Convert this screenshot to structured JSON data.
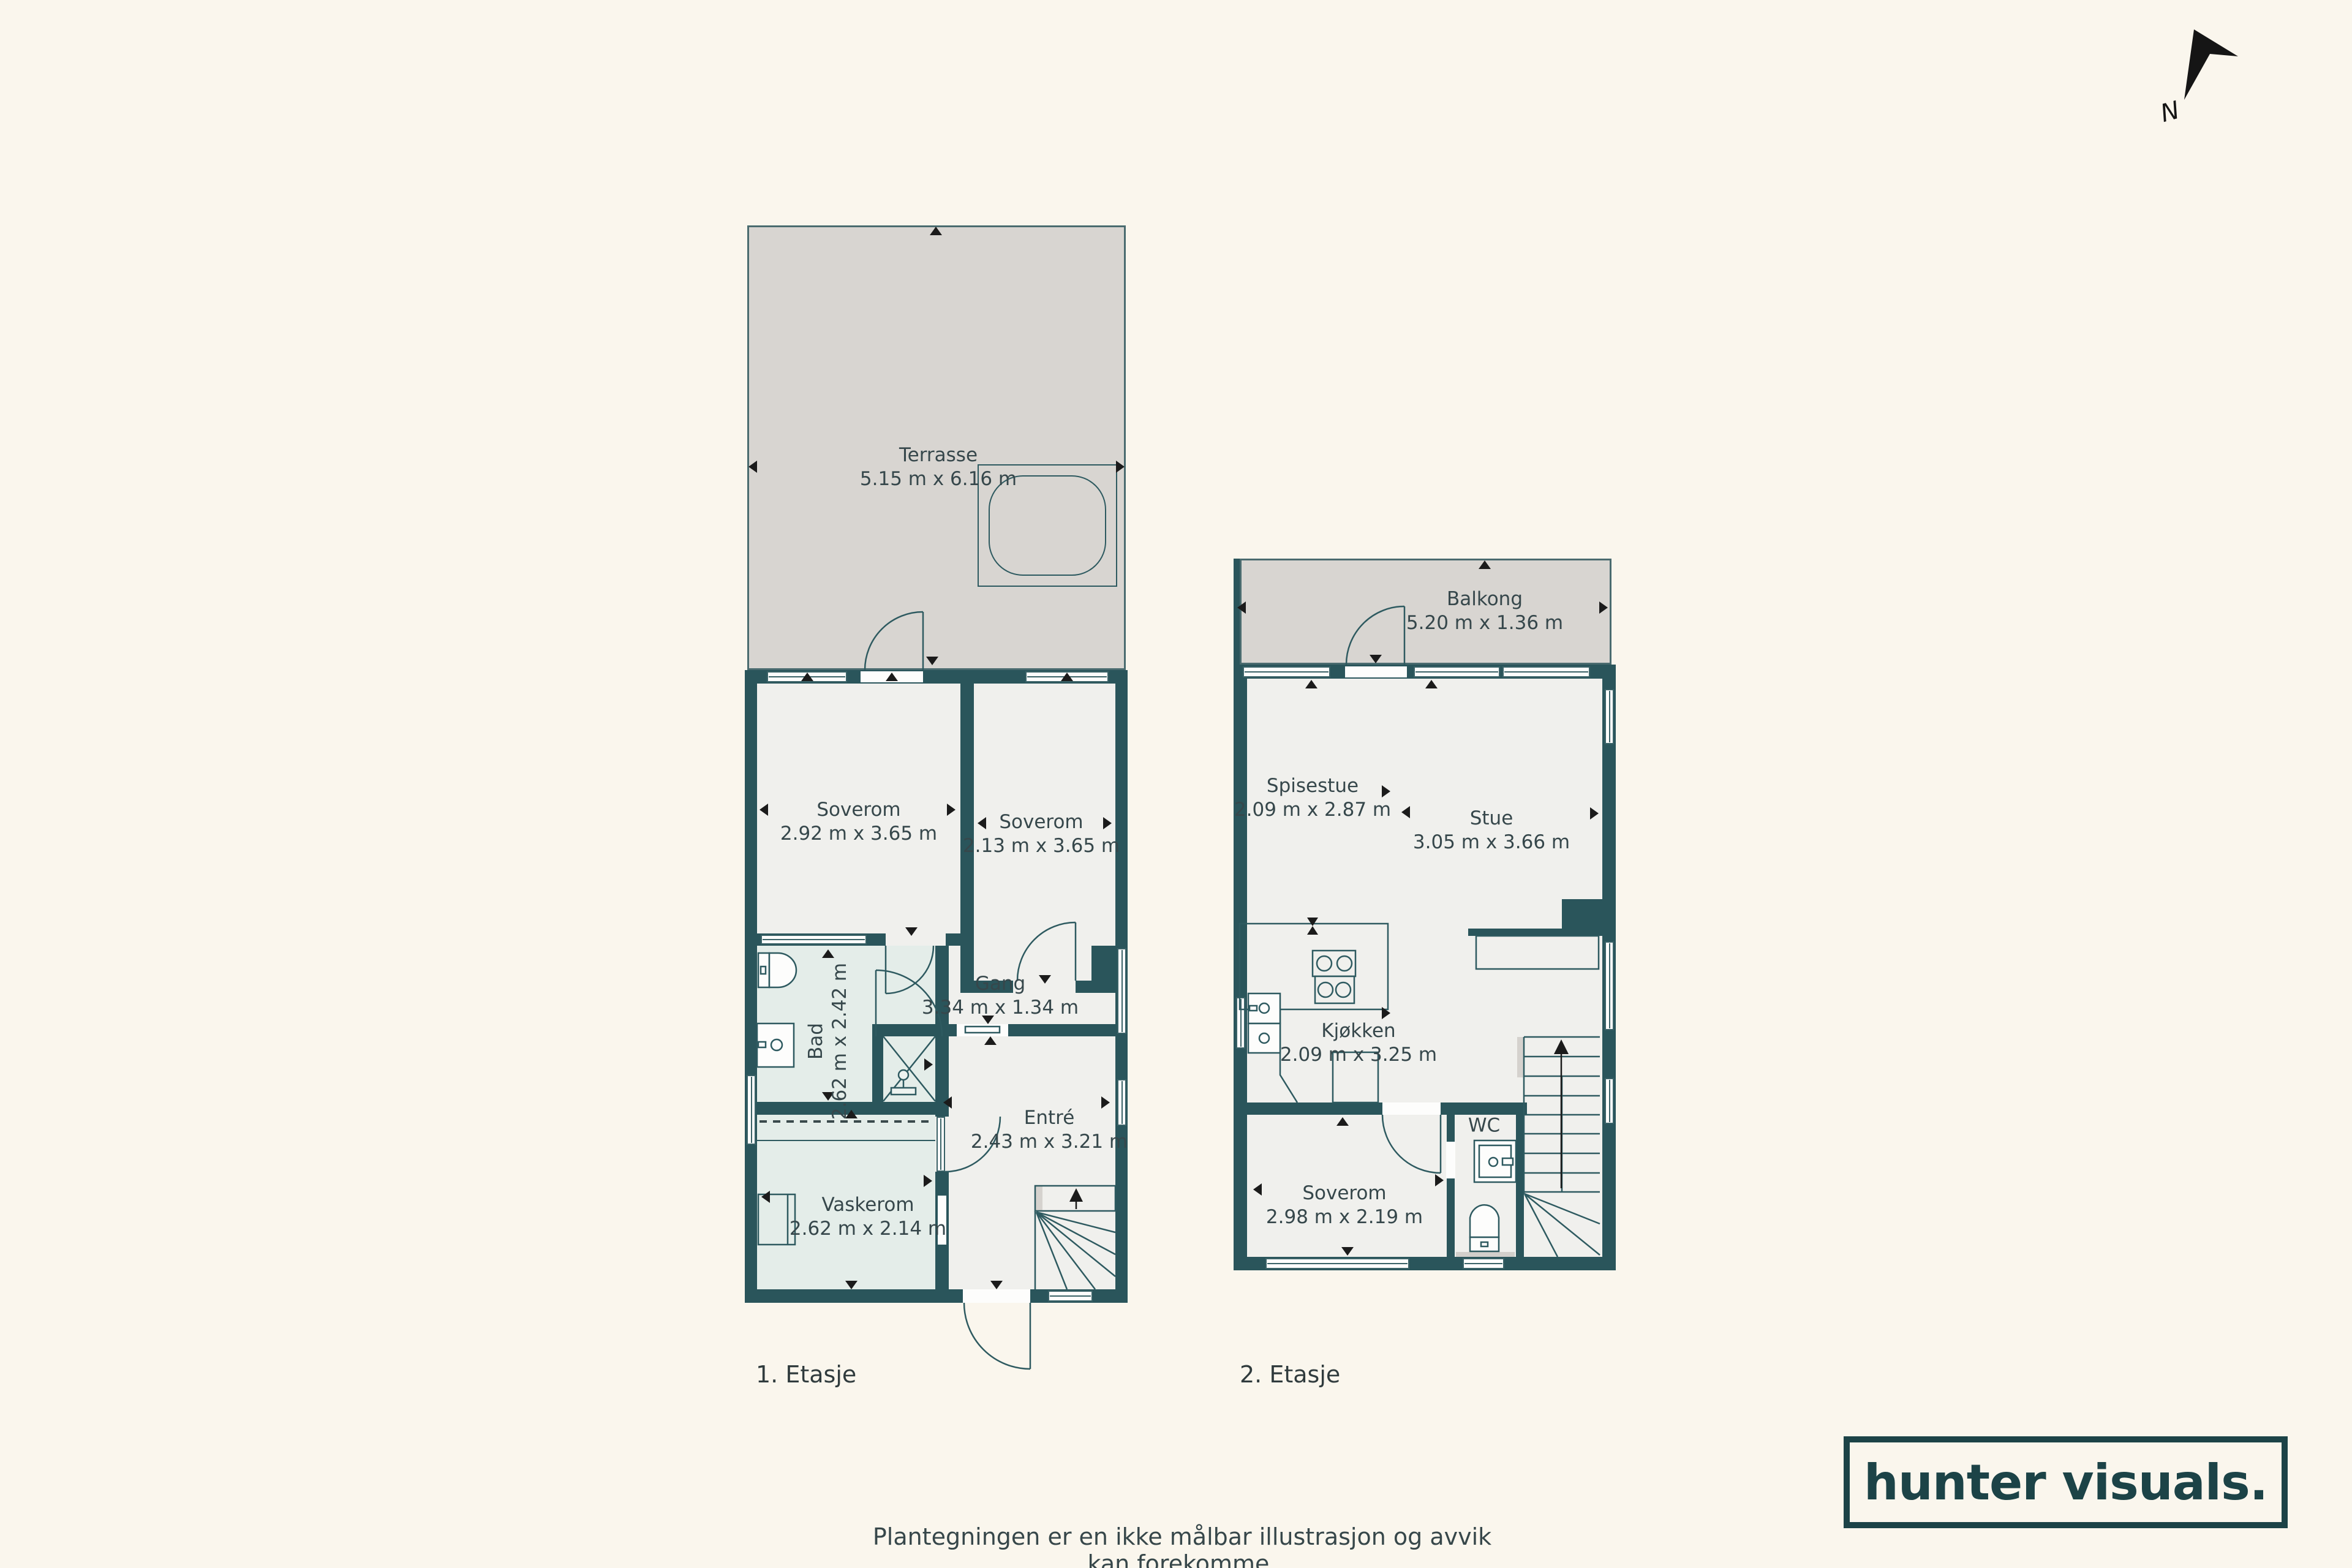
{
  "north": {
    "label": "N"
  },
  "floor1": {
    "label": "1. Etasje",
    "terrasse": {
      "name": "Terrasse",
      "dims": "5.15 m x 6.16 m"
    },
    "soverom_a": {
      "name": "Soverom",
      "dims": "2.92 m x 3.65 m"
    },
    "soverom_b": {
      "name": "Soverom",
      "dims": "2.13 m x 3.65 m"
    },
    "gang": {
      "name": "Gang",
      "dims": "3.34 m x 1.34 m"
    },
    "bad": {
      "name": "Bad",
      "dims": "2.62 m x 2.42 m"
    },
    "entre": {
      "name": "Entré",
      "dims": "2.43 m x 3.21 m"
    },
    "vaskerom": {
      "name": "Vaskerom",
      "dims": "2.62 m x 2.14 m"
    }
  },
  "floor2": {
    "label": "2. Etasje",
    "balkong": {
      "name": "Balkong",
      "dims": "5.20 m x 1.36 m"
    },
    "spisestue": {
      "name": "Spisestue",
      "dims": "2.09 m x 2.87 m"
    },
    "stue": {
      "name": "Stue",
      "dims": "3.05 m x 3.66 m"
    },
    "kjokken": {
      "name": "Kjøkken",
      "dims": "2.09 m x 3.25 m"
    },
    "wc": {
      "name": "WC"
    },
    "soverom": {
      "name": "Soverom",
      "dims": "2.98 m x 2.19 m"
    }
  },
  "footer": {
    "disclaimer": "Plantegningen er en ikke målbar illustrasjon og avvik kan forekomme.",
    "logo_text": "hunter visuals."
  },
  "colors": {
    "background": "#FAF6ED",
    "wall": "#2A555B",
    "room_floor": "#F0F0ED",
    "wet_room_floor": "#E4EDE9",
    "outdoor_floor": "#D8D5D1",
    "logo": "#1C4347"
  }
}
